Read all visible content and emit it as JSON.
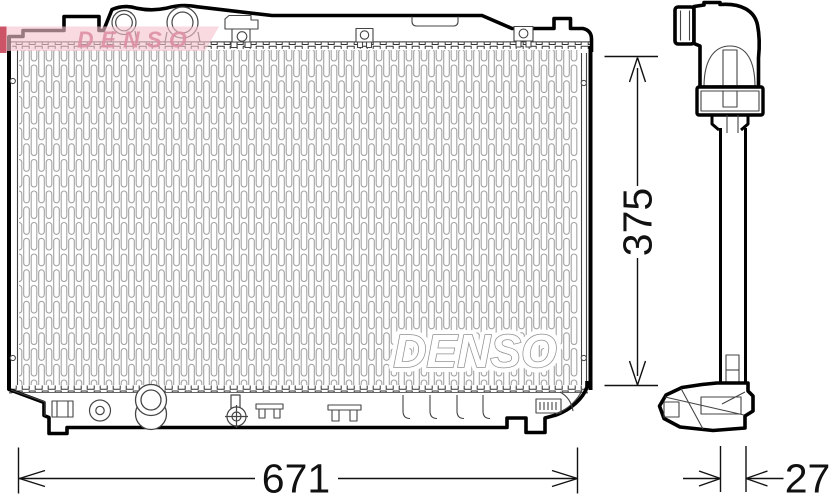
{
  "watermarks": {
    "core": "DENSO",
    "corner": "DENSO"
  },
  "dimensions": {
    "width": "671",
    "height": "375",
    "depth": "27"
  },
  "colors": {
    "outline_black": "#000000",
    "thin_line": "#2b2b2b",
    "fin_gray": "#a3a3a3",
    "watermark_band_pink": "#f3c3cd",
    "watermark_text_pink": "#dd8fa4",
    "watermark_red": "#c53c50",
    "core_watermark_outline": "#8f8f8f"
  }
}
